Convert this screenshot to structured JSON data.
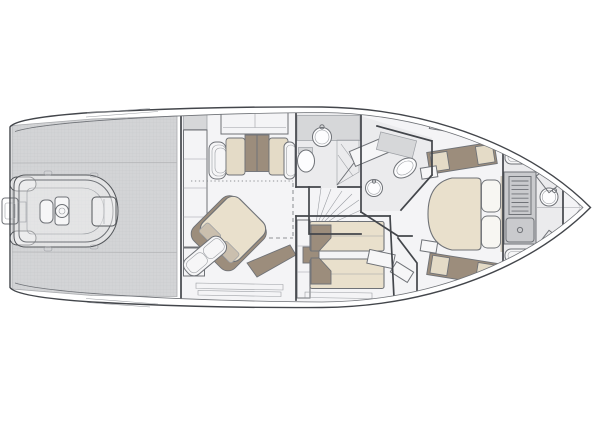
{
  "diagram": {
    "type": "yacht-interior-deck-plan",
    "orientation": "bow-right",
    "text_labels": []
  },
  "colors": {
    "background": "#ffffff",
    "line": "#43464b",
    "line-soft": "#6f7277",
    "line-faint": "#9b9ea3",
    "platform": "#d3d4d6",
    "platform-grid": "#c5c6c8",
    "floor": "#f4f4f6",
    "room": "#ebebed",
    "counter": "#d6d7d9",
    "fixture": "#c9cacd",
    "white-furn": "#f6f6f7",
    "bed": "#e9e0cc",
    "cushion": "#e4dbc7",
    "brown": "#9c8d7c",
    "pillow-muted": "#cabfae"
  },
  "areas": [
    {
      "name": "swim-platform-garage",
      "furniture": [
        "teak-grid-deck",
        "garage-door-seams",
        "stored-tender"
      ]
    },
    {
      "name": "tender",
      "furniture": [
        "outboard-motor",
        "stern-tube-ends",
        "jockey-seat",
        "helm-console",
        "steering-wheel",
        "bow-sunpad"
      ]
    },
    {
      "name": "master-cabin",
      "furniture": [
        "wardrobe-column",
        "sideboard",
        "sofa",
        "diagonal-double-bed",
        "bed-pillows",
        "chaise-seat",
        "hull-side-steps"
      ]
    },
    {
      "name": "master-bathroom",
      "furniture": [
        "vanity-counter",
        "round-sink",
        "toilet",
        "shower"
      ]
    },
    {
      "name": "staircase",
      "furniture": [
        "fanned-steps"
      ]
    },
    {
      "name": "twin-guest-cabin",
      "furniture": [
        "single-bed-port",
        "single-bed-starboard",
        "nightstand",
        "wardrobe",
        "step-locker"
      ]
    },
    {
      "name": "vip-bathroom",
      "furniture": [
        "bench",
        "vanity-counter",
        "toilet",
        "round-sink"
      ]
    },
    {
      "name": "vip-cabin",
      "furniture": [
        "hull-window",
        "side-bench-port",
        "side-bench-starboard",
        "island-bed",
        "pillows",
        "headboard",
        "side-tables",
        "corridor-steps"
      ]
    },
    {
      "name": "crew-quarters",
      "furniture": [
        "berth-port",
        "berth-starboard",
        "ladder",
        "sink-unit",
        "wash-basin",
        "companionway-steps-port",
        "companionway-steps-starboard"
      ]
    },
    {
      "name": "bow-locker",
      "furniture": [
        "anchor-locker-lines"
      ]
    }
  ]
}
